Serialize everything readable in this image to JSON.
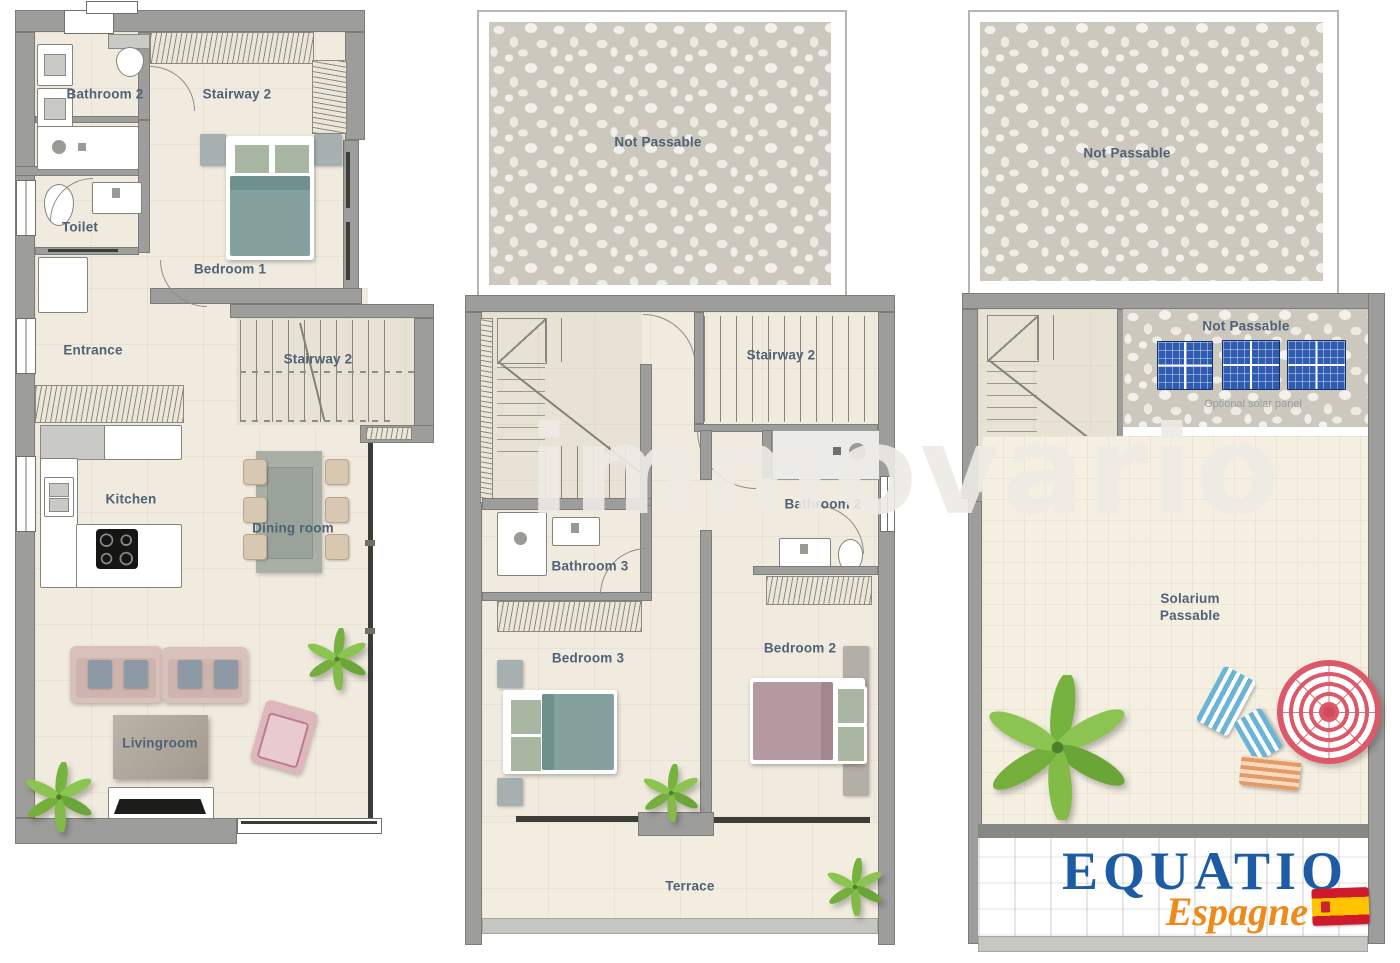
{
  "watermark": "immovario",
  "colors": {
    "wall": "#9d9d9b",
    "floor": "#f1ebdf",
    "label": "#4f6276",
    "bed_teal": "#84a19e",
    "bed_mauve": "#b59aa2",
    "sofa": "#d7c1b9",
    "solar_blue": "#2f5cb0",
    "logo_blue": "#1d5ba4",
    "logo_orange": "#ef8a1a",
    "flag_red": "#cf1a2b",
    "flag_yellow": "#ffc300",
    "plant_green": "#7db842"
  },
  "ground": {
    "labels": {
      "bathroom2": "Bathroom 2",
      "stairway2_top": "Stairway 2",
      "toilet": "Toilet",
      "bedroom1": "Bedroom 1",
      "entrance": "Entrance",
      "stairway2": "Stairway 2",
      "kitchen": "Kitchen",
      "dining_room": "Dining room",
      "livingroom": "Livingroom"
    }
  },
  "first": {
    "labels": {
      "not_passable": "Not Passable",
      "stairway2": "Stairway 2",
      "bathroom2": "Bathroom 2",
      "bathroom3": "Bathroom 3",
      "bedroom3": "Bedroom 3",
      "bedroom2": "Bedroom 2",
      "terrace": "Terrace"
    }
  },
  "roof": {
    "labels": {
      "not_passable_top": "Not Passable",
      "not_passable_solar": "Not Passable",
      "optional_solar_panel": "Optional solar panel",
      "stairway": "Stairway",
      "solarium_line1": "Solarium",
      "solarium_line2": "Passable"
    },
    "logo": {
      "brand": "EQUATIO",
      "region": "Espagne"
    }
  }
}
